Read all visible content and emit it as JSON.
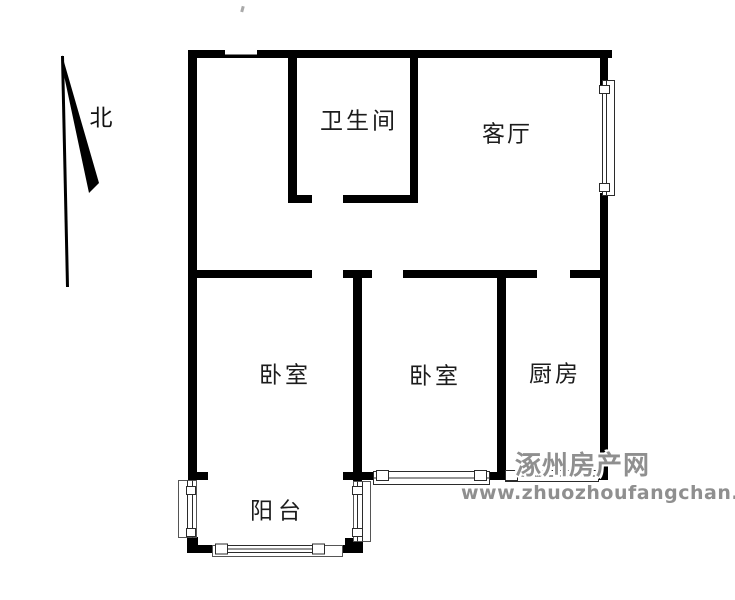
{
  "compass": {
    "label": "北"
  },
  "rooms": [
    {
      "name": "bathroom",
      "label": "卫生间"
    },
    {
      "name": "living-room",
      "label": "客厅"
    },
    {
      "name": "bedroom-west",
      "label": "卧室"
    },
    {
      "name": "bedroom-middle",
      "label": "卧室"
    },
    {
      "name": "kitchen",
      "label": "厨房"
    },
    {
      "name": "balcony",
      "label": "阳台"
    }
  ],
  "watermark": {
    "site_name": "涿州房产网",
    "url": "www.zhuozhoufangchan.com",
    "color": "#8f8f8f"
  },
  "colors": {
    "wall": "#000000",
    "background": "#ffffff",
    "window_outline": "#2b2b2b",
    "label_text": "#1c1c1c"
  }
}
